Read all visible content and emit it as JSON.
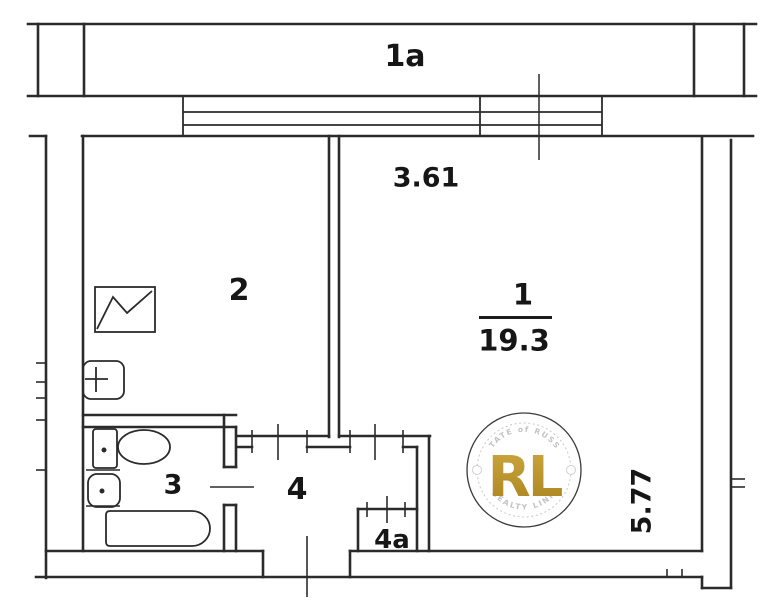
{
  "plan": {
    "rooms": [
      {
        "id": "1a",
        "label": "1a"
      },
      {
        "id": "1",
        "label": "1",
        "area": "19.3"
      },
      {
        "id": "2",
        "label": "2"
      },
      {
        "id": "3",
        "label": "3"
      },
      {
        "id": "4",
        "label": "4"
      },
      {
        "id": "4a",
        "label": "4a"
      }
    ],
    "dimensions": {
      "top": "3.61",
      "right": "5.77"
    }
  },
  "watermark": {
    "arc_top": "ESTATE of RUSSIA",
    "monogram": "RL",
    "arc_bottom": "REALTY LINK",
    "gold": "#bf9b30",
    "gray": "#c3c3c3"
  },
  "colors": {
    "ink": "#2b2b2b",
    "paper": "#ffffff"
  }
}
